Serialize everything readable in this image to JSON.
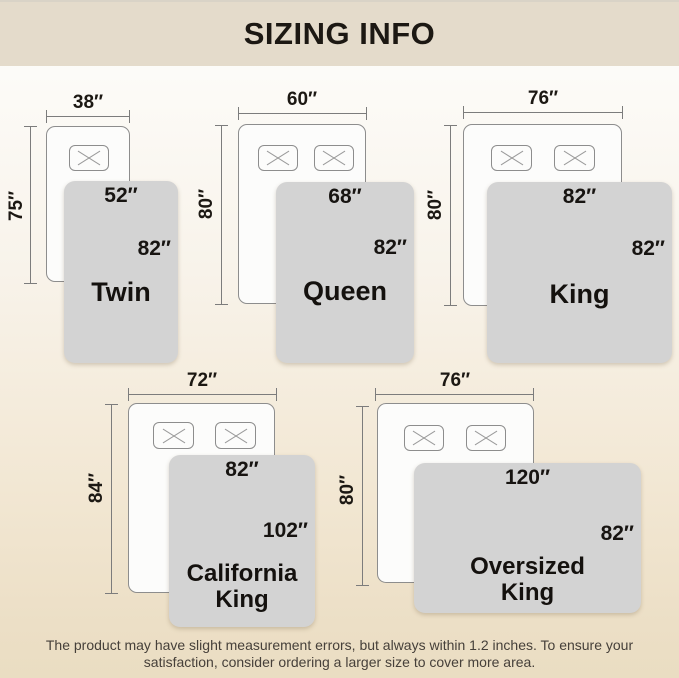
{
  "header": {
    "title": "SIZING INFO"
  },
  "footer": {
    "line1": "The product may have slight measurement errors, but always within 1.2 inches. To ensure your",
    "line2": "satisfaction, consider ordering a larger size to cover more area."
  },
  "colors": {
    "band_bg": "#e4dbcb",
    "page_bottom": "#eaddc2",
    "bed_fill": "#fcfcfb",
    "blanket": "#d3d3d3",
    "line": "#7c7c7c",
    "text_dark": "#1c1813"
  },
  "sizes": [
    {
      "name_line1": "Twin",
      "name_line2": "",
      "bed_width": "38″",
      "bed_height": "75″",
      "blanket_width": "52″",
      "blanket_height": "82″"
    },
    {
      "name_line1": "Queen",
      "name_line2": "",
      "bed_width": "60″",
      "bed_height": "80″",
      "blanket_width": "68″",
      "blanket_height": "82″"
    },
    {
      "name_line1": "King",
      "name_line2": "",
      "bed_width": "76″",
      "bed_height": "80″",
      "blanket_width": "82″",
      "blanket_height": "82″"
    },
    {
      "name_line1": "California",
      "name_line2": "King",
      "bed_width": "72″",
      "bed_height": "84″",
      "blanket_width": "82″",
      "blanket_height": "102″"
    },
    {
      "name_line1": "Oversized",
      "name_line2": "King",
      "bed_width": "76″",
      "bed_height": "80″",
      "blanket_width": "120″",
      "blanket_height": "82″"
    }
  ]
}
